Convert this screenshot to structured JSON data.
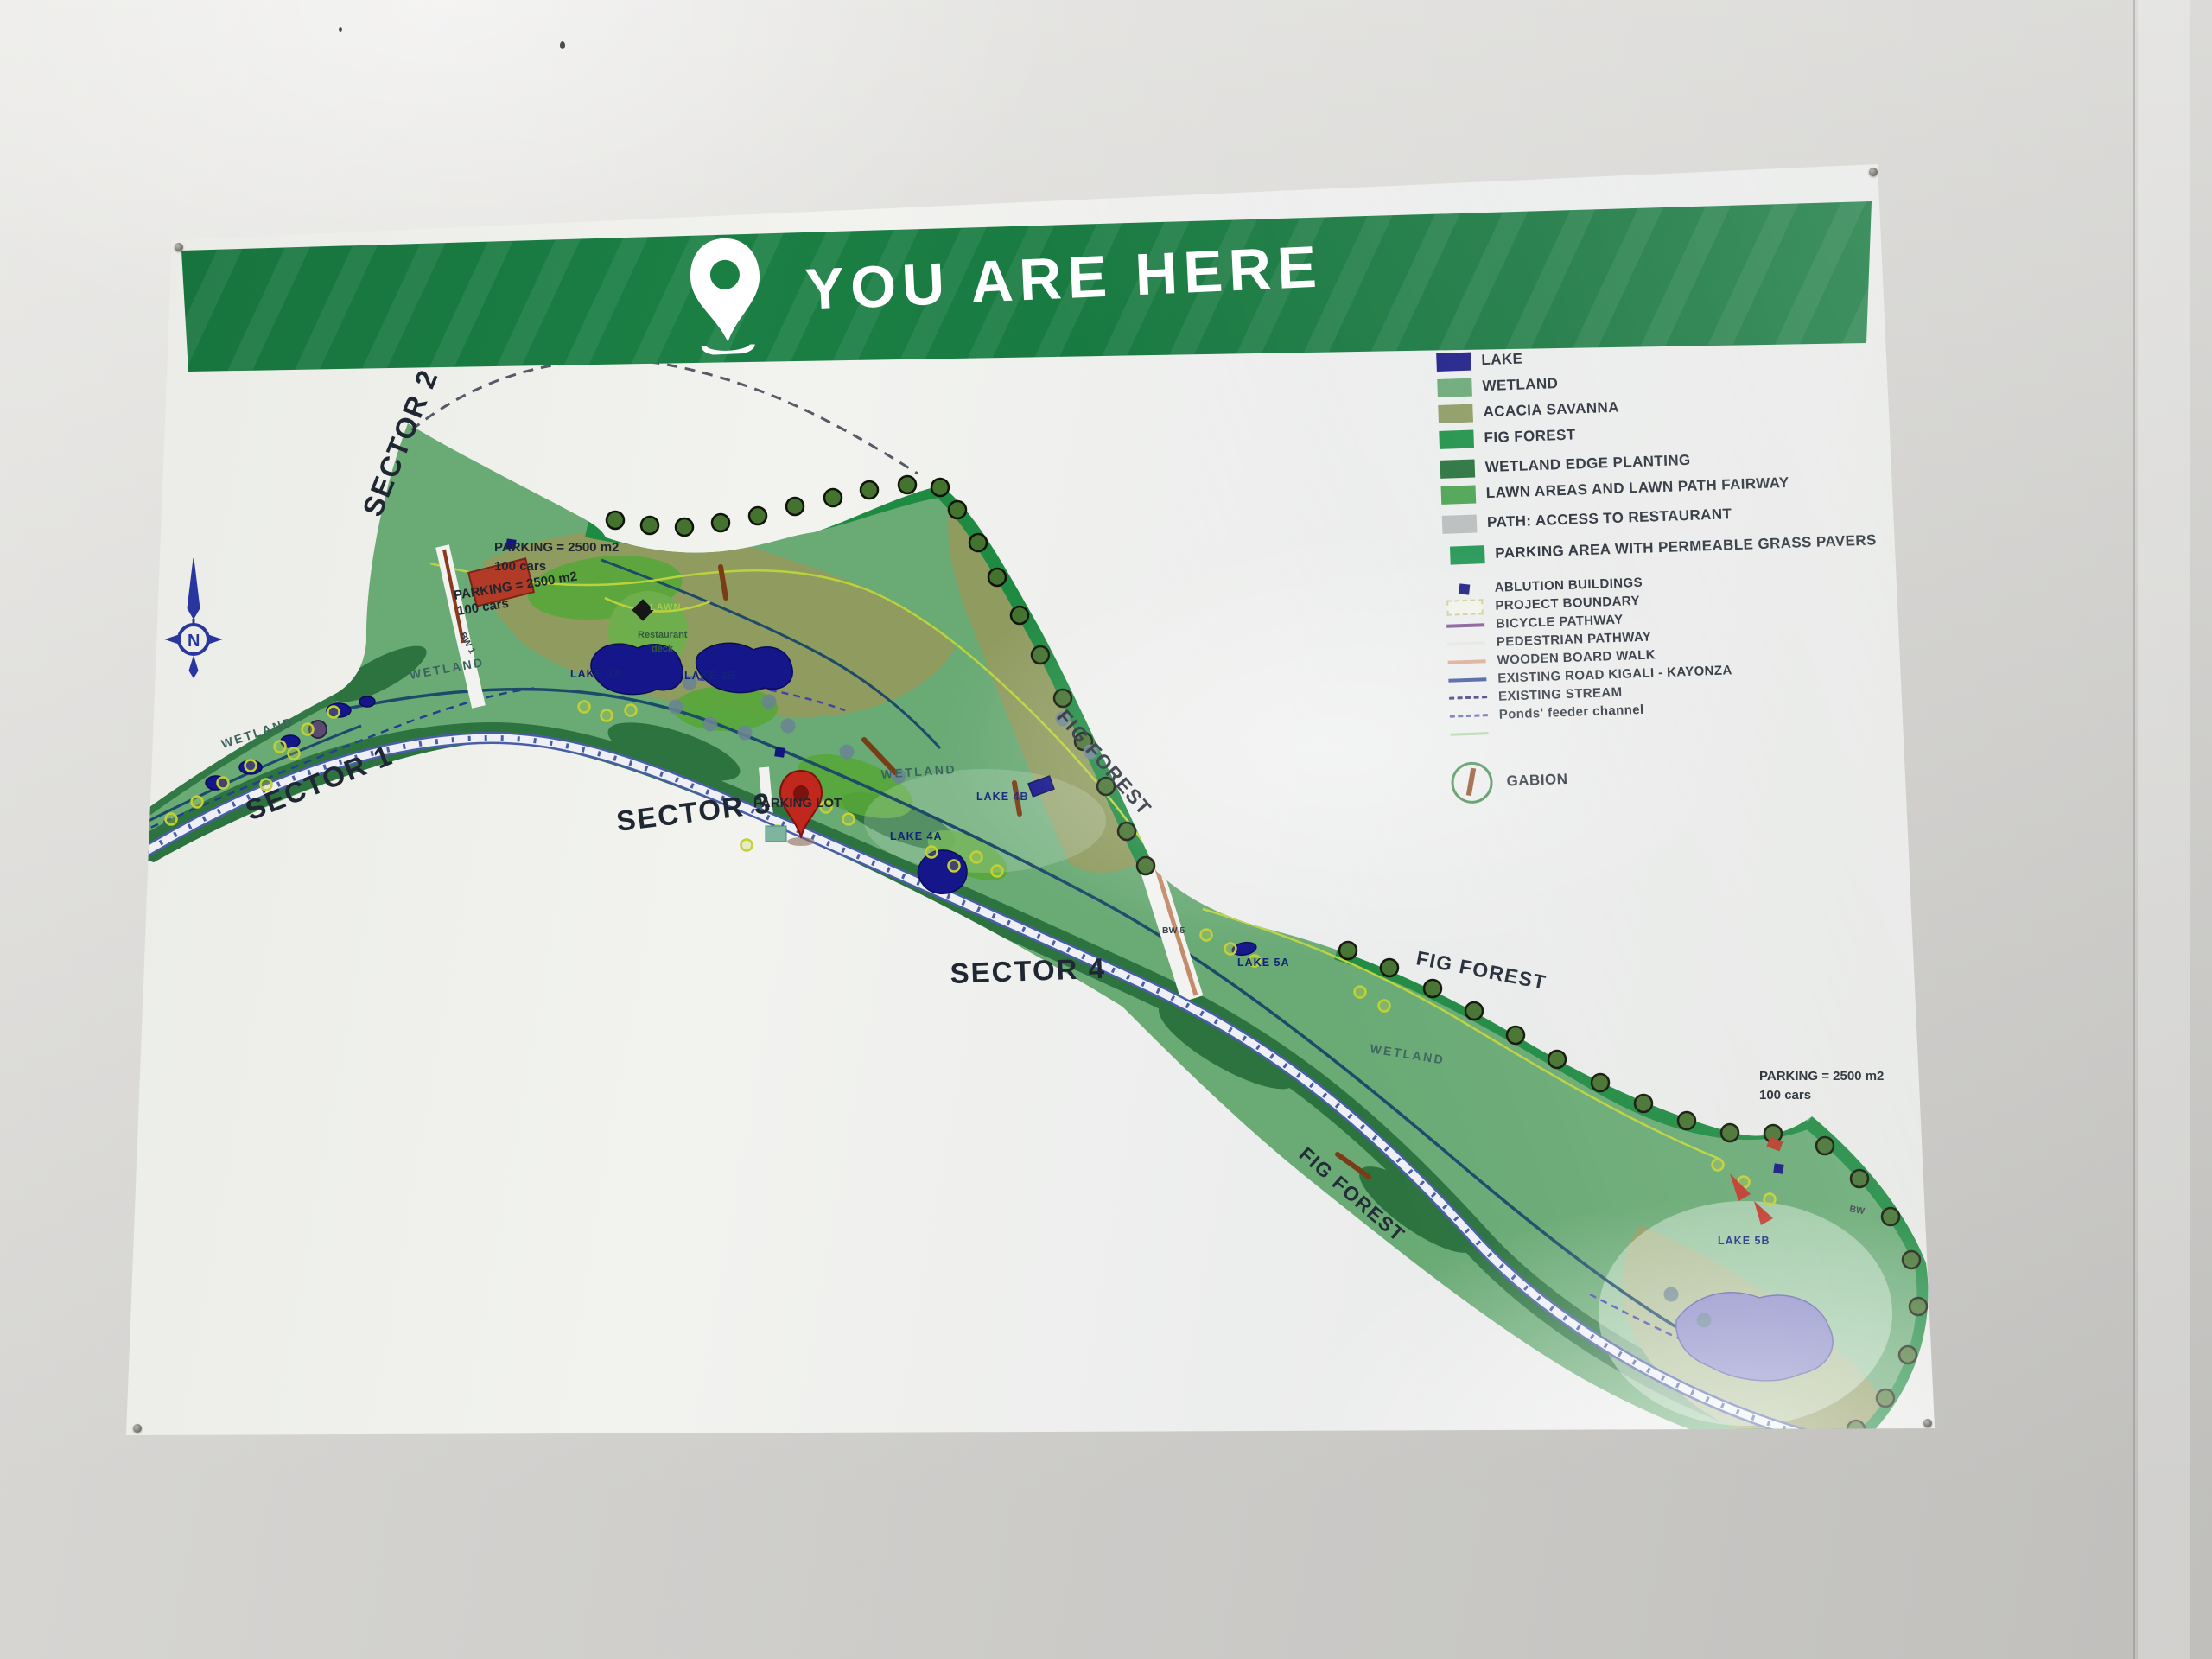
{
  "header": {
    "title": "YOU ARE HERE"
  },
  "colors": {
    "header_green": "#1b7f44",
    "lake_blue": "#1c1d87",
    "wetland_green": "#6aa876",
    "acacia_olive": "#8d9a63",
    "fig_green": "#1e9048",
    "road_blue": "#2d4a96",
    "pin_red": "#c0281e"
  },
  "legend": {
    "areas": [
      {
        "label": "LAKE",
        "color": "#1c1d87"
      },
      {
        "label": "WETLAND",
        "color": "#6aa876"
      },
      {
        "label": "ACACIA SAVANNA",
        "color": "#8d9a63"
      },
      {
        "label": "FIG FOREST",
        "color": "#1e9048"
      },
      {
        "label": "WETLAND EDGE PLANTING",
        "color": "#27713c"
      },
      {
        "label": "LAWN AREAS AND LAWN PATH FAIRWAY",
        "color": "#4aa352"
      },
      {
        "label": "PATH: ACCESS TO RESTAURANT",
        "color": "#b9bdbd"
      },
      {
        "label": "PARKING AREA WITH PERMEABLE GRASS PAVERS",
        "color": "#1f9551"
      }
    ],
    "symbols": [
      {
        "label": "ABLUTION BUILDINGS",
        "symbol": "square",
        "color": "#14157e"
      },
      {
        "label": "PROJECT BOUNDARY",
        "symbol": "dashed-box",
        "color": "#c9cf9a"
      },
      {
        "label": "BICYCLE PATHWAY",
        "symbol": "line",
        "color": "#7a4f8f"
      },
      {
        "label": "PEDESTRIAN PATHWAY",
        "symbol": "line",
        "color": "#e3e5df"
      },
      {
        "label": "WOODEN BOARD WALK",
        "symbol": "line",
        "color": "#d9a38a"
      },
      {
        "label": "EXISTING ROAD KIGALI - KAYONZA",
        "symbol": "line",
        "color": "#2d4a96"
      },
      {
        "label": "EXISTING STREAM",
        "symbol": "dashed-line",
        "color": "#27276e"
      },
      {
        "label": "Ponds' feeder channel",
        "symbol": "dashed-line",
        "color": "#5b5bb0"
      },
      {
        "label": "",
        "symbol": "line",
        "color": "#a8d4a0"
      }
    ],
    "gabion_label": "GABION"
  },
  "map": {
    "sector_labels": [
      "SECTOR 1",
      "SECTOR 2",
      "SECTOR 3",
      "SECTOR 4"
    ],
    "labels": {
      "fig_forest_a": "FIG FOREST",
      "fig_forest_b": "FIG FOREST",
      "fig_forest_c": "FIG FOREST",
      "wetland_a": "WETLAND",
      "wetland_b": "WETLAND",
      "wetland_c": "WETLAND",
      "wetland_d": "WETLAND",
      "lawn": "LAWN",
      "restaurant_line1": "Restaurant",
      "restaurant_line2": "deck",
      "lake_3a": "LAKE 3A",
      "lake_3b": "LAKE 3B",
      "lake_4a": "LAKE 4A",
      "lake_4b": "LAKE 4B",
      "lake_5a": "LAKE 5A",
      "lake_5b": "LAKE 5B",
      "bw_1": "BW 1",
      "bw_2": "BW 2",
      "bw_5": "BW 5",
      "bw_6": "BW",
      "parking_nw_1": "PARKING = 2500 m2",
      "parking_nw_2": "100 cars",
      "parking_nw_dup_1": "PARKING = 2500 m2",
      "parking_nw_dup_2": "100 cars",
      "parking_se_1": "PARKING = 2500 m2",
      "parking_se_2": "100 cars",
      "you_are_here_parking": "PARKING LOT",
      "compass_n": "N"
    }
  }
}
